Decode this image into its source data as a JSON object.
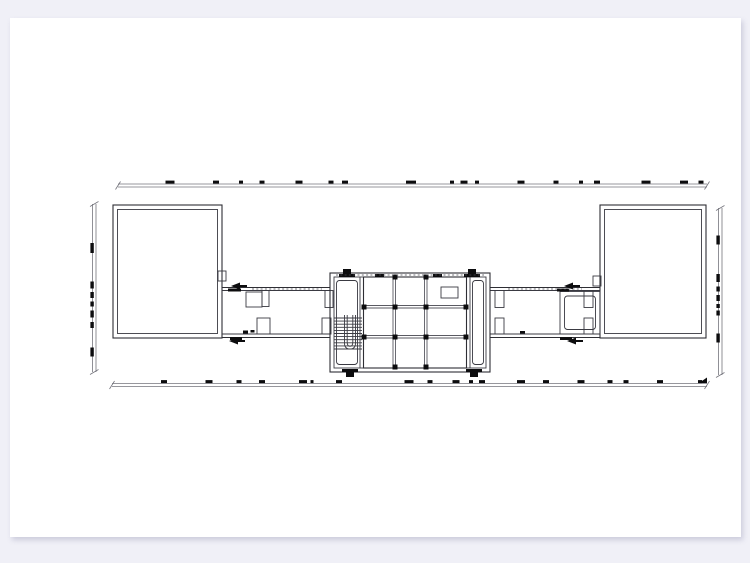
{
  "canvas": {
    "background_color": "#f0f0f7",
    "paper_color": "#ffffff",
    "content_kind": "architectural floor plan, second-level slab plan with central atrium grid and stair"
  },
  "drawing": {
    "colors": {
      "wall": "#2e2e34",
      "beam": "#5a5a62",
      "dimension": "#74747c",
      "ink": "#0c0c0e"
    },
    "dim_lines": [
      {
        "name": "dim-line-top",
        "orient": "h",
        "x1": 118,
        "x2": 707,
        "y": 184,
        "blobs": [
          [
            170,
            9
          ],
          [
            216,
            6
          ],
          [
            241,
            4
          ],
          [
            262,
            5
          ],
          [
            299,
            7
          ],
          [
            331,
            5
          ],
          [
            345,
            6
          ],
          [
            411,
            10
          ],
          [
            452,
            4
          ],
          [
            464,
            7
          ],
          [
            477,
            4
          ],
          [
            521,
            7
          ],
          [
            556,
            5
          ],
          [
            581,
            4
          ],
          [
            597,
            6
          ],
          [
            646,
            9
          ],
          [
            684,
            8
          ],
          [
            701,
            5
          ]
        ]
      },
      {
        "name": "dim-line-bottom",
        "orient": "h",
        "x1": 112,
        "x2": 707,
        "y": 383.5,
        "end_arrow": true,
        "blobs": [
          [
            164,
            6
          ],
          [
            209,
            7
          ],
          [
            239,
            5
          ],
          [
            262,
            6
          ],
          [
            303,
            8
          ],
          [
            312,
            3
          ],
          [
            339,
            6
          ],
          [
            409,
            9
          ],
          [
            430,
            5
          ],
          [
            456,
            7
          ],
          [
            471,
            4
          ],
          [
            482,
            6
          ],
          [
            521,
            8
          ],
          [
            546,
            6
          ],
          [
            581,
            7
          ],
          [
            610,
            5
          ],
          [
            626,
            5
          ],
          [
            660,
            6
          ],
          [
            700,
            4
          ]
        ]
      },
      {
        "name": "dim-line-left",
        "orient": "v",
        "x": 92.5,
        "y1": 204,
        "y2": 372,
        "blobs": [
          [
            248,
            10
          ],
          [
            285,
            7
          ],
          [
            295,
            6
          ],
          [
            304,
            5
          ],
          [
            314,
            7
          ],
          [
            325,
            6
          ],
          [
            352,
            9
          ]
        ]
      },
      {
        "name": "dim-line-right",
        "orient": "v",
        "x": 718.5,
        "y1": 208,
        "y2": 375,
        "blobs": [
          [
            240,
            9
          ],
          [
            278,
            8
          ],
          [
            289,
            5
          ],
          [
            298,
            6
          ],
          [
            306,
            4
          ],
          [
            313,
            5
          ],
          [
            338,
            9
          ]
        ]
      }
    ],
    "grid_columns": [
      [
        395,
        307
      ],
      [
        426,
        307
      ],
      [
        395,
        337
      ],
      [
        426,
        337
      ],
      [
        364,
        307
      ],
      [
        364,
        337
      ],
      [
        466,
        307
      ],
      [
        466,
        337
      ],
      [
        395,
        277
      ],
      [
        426,
        277
      ],
      [
        395,
        367
      ],
      [
        426,
        367
      ]
    ],
    "door_flags": [
      {
        "x": 347,
        "y": 271,
        "dir": "up"
      },
      {
        "x": 472,
        "y": 271,
        "dir": "up"
      },
      {
        "x": 350,
        "y": 375,
        "dir": "down"
      },
      {
        "x": 474,
        "y": 375,
        "dir": "down"
      }
    ],
    "door_arrows": [
      {
        "x": 237,
        "y": 286
      },
      {
        "x": 235,
        "y": 341
      },
      {
        "x": 570,
        "y": 286
      },
      {
        "x": 573,
        "y": 341
      }
    ],
    "minor_marks": [
      [
        228,
        288.5,
        13,
        3
      ],
      [
        230,
        337,
        12,
        3
      ],
      [
        557,
        288.5,
        12,
        3
      ],
      [
        560,
        337,
        12,
        3
      ],
      [
        243,
        330.5,
        5,
        3
      ],
      [
        250.5,
        330,
        4,
        2.5
      ],
      [
        520,
        331,
        5,
        2.5
      ],
      [
        375,
        274,
        9,
        3
      ],
      [
        433,
        274,
        9,
        3
      ]
    ],
    "stair": {
      "x1": 334,
      "x2": 362,
      "y_start": 318,
      "step": 3.1,
      "count": 11
    },
    "dash_lines": [
      {
        "x1": 252,
        "x2": 322,
        "y": 289
      },
      {
        "x1": 508,
        "x2": 582,
        "y": 289
      },
      {
        "x1": 336,
        "x2": 484,
        "y": 275
      }
    ]
  }
}
